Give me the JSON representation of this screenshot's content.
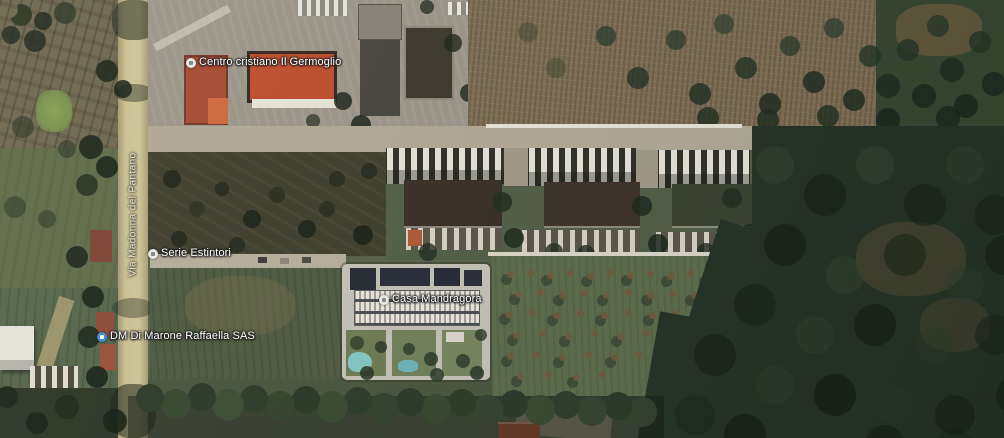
{
  "map": {
    "label_color": "#ffffff",
    "road_label": {
      "text": "Via Madonna del Pantano",
      "color": "#ece7d2"
    },
    "pois": [
      {
        "label": "Centro cristiano Il Germoglio",
        "icon": "church",
        "icon_color": "#e8e8e4",
        "glyph_color": "#8a8a86"
      },
      {
        "label": "Serie Estintori",
        "icon": "business",
        "icon_color": "#e8e8e4",
        "glyph_color": "#8a8a86"
      },
      {
        "label": "DM Di Marone Raffaella SAS",
        "icon": "store",
        "icon_color": "#4b8ad2",
        "glyph_color": "#ffffff"
      },
      {
        "label": "Casa Mandragora",
        "icon": "lodging",
        "icon_color": "#e8e8e4",
        "glyph_color": "#8a8a86"
      }
    ]
  }
}
